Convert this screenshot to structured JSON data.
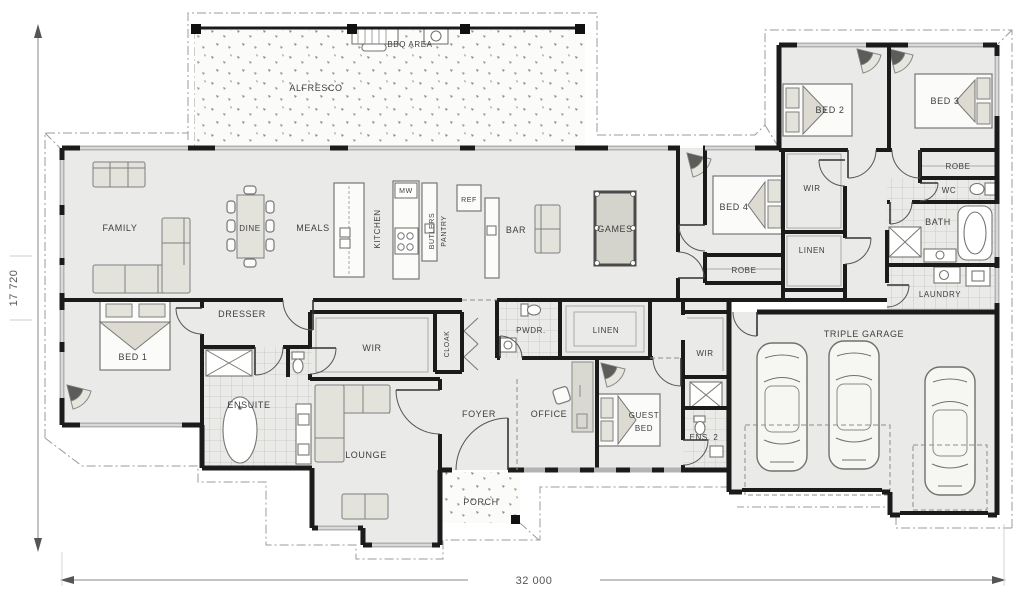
{
  "dimensions": {
    "width": "32 000",
    "height": "17 720"
  },
  "outdoor": {
    "bbq_area": "BBQ AREA",
    "alfresco": "ALFRESCO",
    "porch": "PORCH"
  },
  "living": {
    "family": "FAMILY",
    "dine": "DINE",
    "meals": "MEALS",
    "kitchen": "KITCHEN",
    "microwave": "MW",
    "butlers_line1": "BUTLERS",
    "butlers_line2": "PANTRY",
    "fridge": "REF",
    "bar": "BAR",
    "games": "GAMES",
    "lounge": "LOUNGE",
    "foyer": "FOYER",
    "office": "OFFICE"
  },
  "master": {
    "bed1": "BED 1",
    "dresser": "DRESSER",
    "wir": "WIR",
    "cloak": "CLOAK",
    "ensuite": "ENSUITE"
  },
  "bedrooms": {
    "bed2": "BED 2",
    "bed3": "BED 3",
    "bed4": "BED 4",
    "guest_line1": "GUEST",
    "guest_line2": "BED",
    "wir_wing": "WIR",
    "wir_guest": "WIR",
    "robe_bed3": "ROBE",
    "robe_bed4": "ROBE",
    "linen_wing": "LINEN",
    "linen_hall": "LINEN",
    "ens2": "ENS. 2"
  },
  "utility": {
    "wc": "WC",
    "bath": "BATH",
    "laundry": "LAUNDRY",
    "pwdr": "PWDR.",
    "garage": "TRIPLE GARAGE"
  }
}
